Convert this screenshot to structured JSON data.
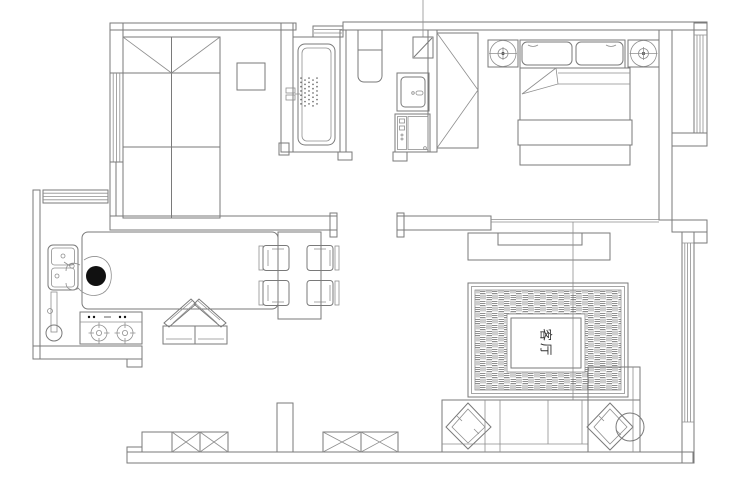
{
  "labels": {
    "living_room": "客厅"
  },
  "colors": {
    "background": "#ffffff",
    "line": "#7a7a7a",
    "figure": "#111111"
  }
}
